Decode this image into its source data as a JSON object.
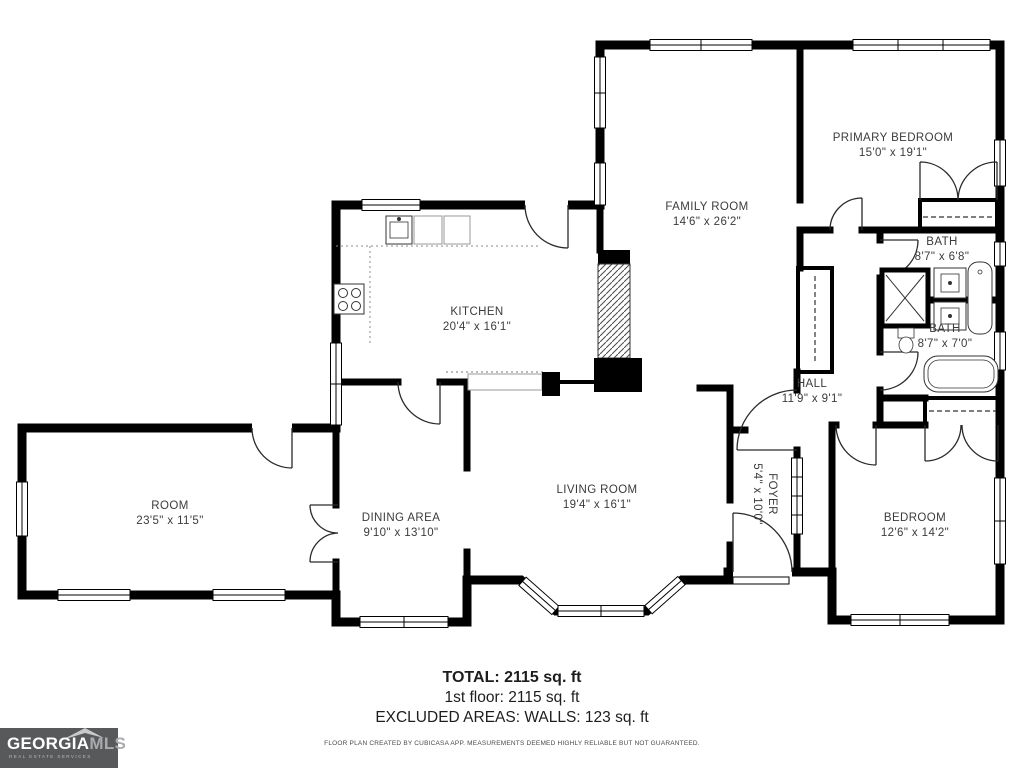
{
  "plan": {
    "rooms": [
      {
        "id": "family-room",
        "name": "FAMILY ROOM",
        "dims": "14'6\" x 26'2\""
      },
      {
        "id": "primary-bedroom",
        "name": "PRIMARY BEDROOM",
        "dims": "15'0\" x 19'1\""
      },
      {
        "id": "bath-upper",
        "name": "BATH",
        "dims": "8'7\" x 6'8\""
      },
      {
        "id": "bath-lower",
        "name": "BATH",
        "dims": "8'7\" x 7'0\""
      },
      {
        "id": "hall",
        "name": "HALL",
        "dims": "11'9\" x 9'1\""
      },
      {
        "id": "kitchen",
        "name": "KITCHEN",
        "dims": "20'4\" x 16'1\""
      },
      {
        "id": "room",
        "name": "ROOM",
        "dims": "23'5\" x 11'5\""
      },
      {
        "id": "dining-area",
        "name": "DINING AREA",
        "dims": "9'10\" x 13'10\""
      },
      {
        "id": "living-room",
        "name": "LIVING ROOM",
        "dims": "19'4\" x 16'1\""
      },
      {
        "id": "foyer",
        "name": "FOYER",
        "dims": "5'4\" x 10'0\""
      },
      {
        "id": "bedroom",
        "name": "BEDROOM",
        "dims": "12'6\" x 14'2\""
      }
    ]
  },
  "summary": {
    "total": "TOTAL: 2115 sq. ft",
    "first_floor": "1st floor: 2115 sq. ft",
    "excluded": "EXCLUDED AREAS: WALLS: 123 sq. ft",
    "disclaimer": "FLOOR PLAN CREATED BY CUBICASA APP. MEASUREMENTS DEEMED HIGHLY RELIABLE BUT NOT GUARANTEED."
  },
  "logo": {
    "brand_primary": "GEORGIA",
    "brand_secondary": "MLS",
    "tagline": "REAL ESTATE SERVICES"
  },
  "colors": {
    "wall": "#000000",
    "label": "#3b3b3b",
    "logo_bg": "#58595b",
    "logo_secondary": "#a9abae"
  }
}
